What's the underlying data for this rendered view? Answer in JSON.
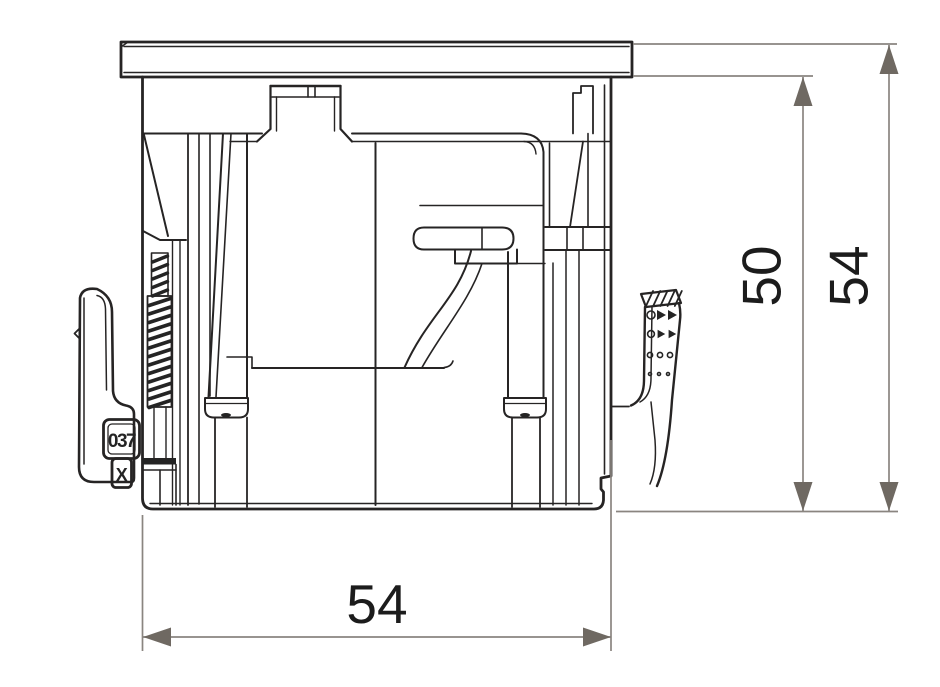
{
  "page": {
    "background": "#ffffff",
    "description": "Technical cross-section drawing of a recessed mounting unit with snap-in clips, spring and dimension annotations"
  },
  "drawing": {
    "colors": {
      "line": "#262424",
      "fill_dark": "#242424",
      "dimension_line": "#8a8580",
      "arrow": "#6f6962",
      "text": "#1c1c1c"
    },
    "labels": {
      "dim_50": "50",
      "dim_54_vertical": "54",
      "dim_54_horizontal": "54",
      "marking_head": "037",
      "marking_stem": "X"
    },
    "dimensions": [
      {
        "id": "body-depth",
        "value": "50",
        "orientation": "vertical",
        "measures": "depth of housing below flange"
      },
      {
        "id": "overall-depth",
        "value": "54",
        "orientation": "vertical",
        "measures": "overall depth including flange"
      },
      {
        "id": "overall-width",
        "value": "54",
        "orientation": "horizontal",
        "measures": "overall housing width"
      }
    ],
    "marking": {
      "head": "037",
      "stem": "X",
      "type": "mold-identification-stamp"
    }
  }
}
